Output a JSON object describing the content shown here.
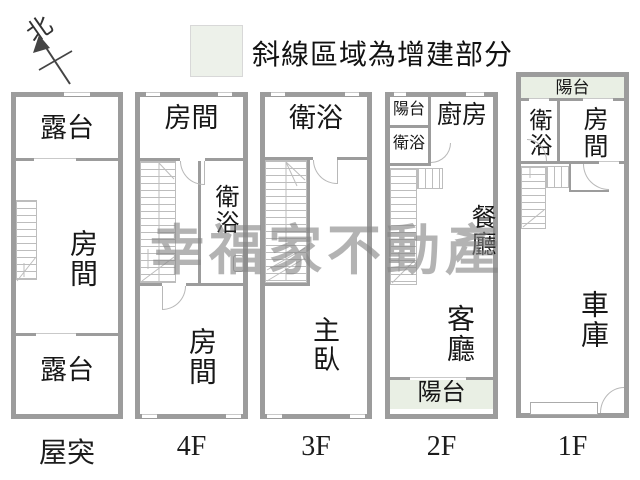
{
  "north": {
    "label": "北"
  },
  "legend": {
    "text": "斜線區域為增建部分"
  },
  "watermark": {
    "text": "幸福家不動產"
  },
  "colors": {
    "wall": "#9c9c9c",
    "thin_line": "#bdbdbd",
    "addition_fill": "#e9efe4",
    "watermark_gray": "#848484",
    "text": "#171717"
  },
  "floors": {
    "roof": {
      "label": "屋突",
      "terrace_top": "露台",
      "room": "房間",
      "terrace_bottom": "露台"
    },
    "f4": {
      "label": "4F",
      "room_top": "房間",
      "bath": "衛浴",
      "room_bottom": "房間"
    },
    "f3": {
      "label": "3F",
      "bath": "衛浴",
      "master": "主臥"
    },
    "f2": {
      "label": "2F",
      "balcony_top": "陽台",
      "bath": "衛浴",
      "kitchen": "廚房",
      "dining": "餐廳",
      "living": "客廳",
      "balcony_bottom": "陽台"
    },
    "f1": {
      "label": "1F",
      "balcony": "陽台",
      "bath": "衛浴",
      "room": "房間",
      "garage": "車庫"
    }
  }
}
